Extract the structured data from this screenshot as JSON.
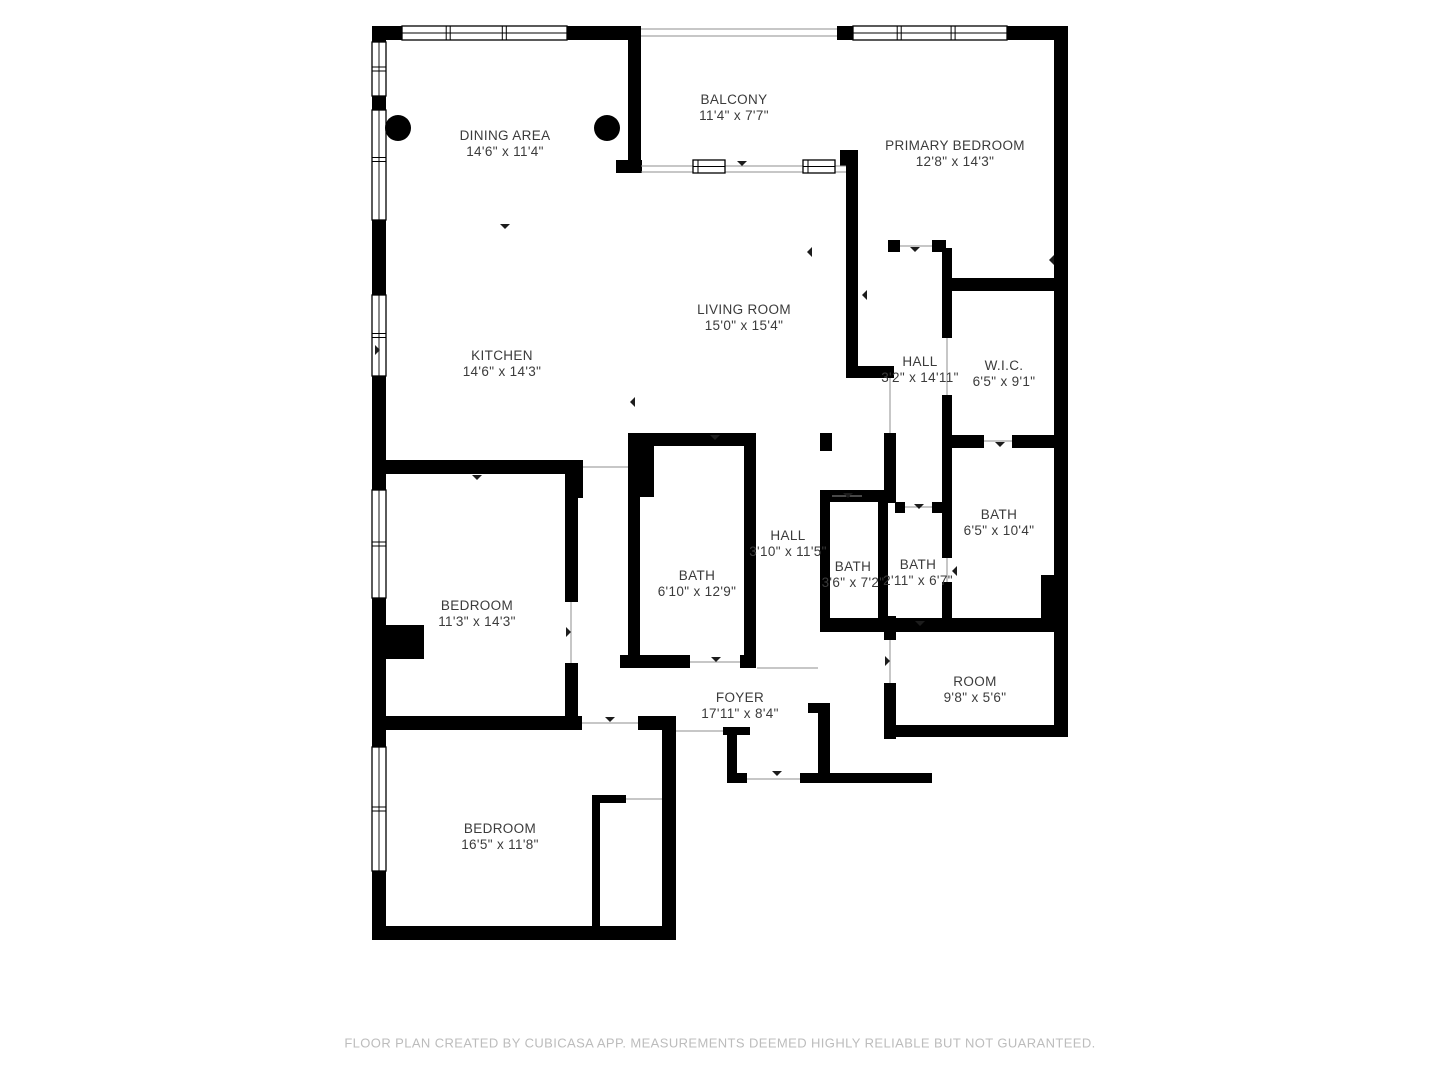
{
  "colors": {
    "wall": "#000000",
    "label": "#3b3b3b",
    "footer": "#bcbcbc",
    "thin_line": "#8f8f8f",
    "background": "#ffffff"
  },
  "rooms": [
    {
      "id": "balcony",
      "name": "BALCONY",
      "dims": "11'4\" x 7'7\"",
      "x": 734,
      "y": 108
    },
    {
      "id": "dining-area",
      "name": "DINING AREA",
      "dims": "14'6\" x 11'4\"",
      "x": 505,
      "y": 144
    },
    {
      "id": "primary-bedroom",
      "name": "PRIMARY BEDROOM",
      "dims": "12'8\" x 14'3\"",
      "x": 955,
      "y": 154
    },
    {
      "id": "living-room",
      "name": "LIVING ROOM",
      "dims": "15'0\" x 15'4\"",
      "x": 744,
      "y": 318
    },
    {
      "id": "kitchen",
      "name": "KITCHEN",
      "dims": "14'6\" x 14'3\"",
      "x": 502,
      "y": 364
    },
    {
      "id": "hall-upper",
      "name": "HALL",
      "dims": "3'2\" x 14'11\"",
      "x": 920,
      "y": 370
    },
    {
      "id": "wic",
      "name": "W.I.C.",
      "dims": "6'5\" x 9'1\"",
      "x": 1004,
      "y": 374
    },
    {
      "id": "bath-ensuite",
      "name": "BATH",
      "dims": "6'5\" x 10'4\"",
      "x": 999,
      "y": 523
    },
    {
      "id": "hall-lower",
      "name": "HALL",
      "dims": "3'10\" x 11'5\"",
      "x": 788,
      "y": 544
    },
    {
      "id": "bath-main",
      "name": "BATH",
      "dims": "6'10\" x 12'9\"",
      "x": 697,
      "y": 584
    },
    {
      "id": "bath-a",
      "name": "BATH",
      "dims": "3'6\" x 7'2\"",
      "x": 853,
      "y": 575
    },
    {
      "id": "bath-b",
      "name": "BATH",
      "dims": "2'11\" x 6'7\"",
      "x": 918,
      "y": 573
    },
    {
      "id": "bedroom-1",
      "name": "BEDROOM",
      "dims": "11'3\" x 14'3\"",
      "x": 477,
      "y": 614
    },
    {
      "id": "room",
      "name": "ROOM",
      "dims": "9'8\" x 5'6\"",
      "x": 975,
      "y": 690
    },
    {
      "id": "foyer",
      "name": "FOYER",
      "dims": "17'11\" x 8'4\"",
      "x": 740,
      "y": 706
    },
    {
      "id": "bedroom-2",
      "name": "BEDROOM",
      "dims": "16'5\" x 11'8\"",
      "x": 500,
      "y": 837
    }
  ],
  "plan": {
    "walls": [
      [
        372,
        26,
        32,
        14
      ],
      [
        567,
        26,
        70,
        14
      ],
      [
        837,
        26,
        16,
        14
      ],
      [
        1007,
        26,
        61,
        14
      ],
      [
        372,
        26,
        14,
        16
      ],
      [
        372,
        96,
        14,
        14
      ],
      [
        372,
        220,
        14,
        75
      ],
      [
        372,
        376,
        14,
        116
      ],
      [
        372,
        598,
        14,
        60
      ],
      [
        372,
        655,
        14,
        75
      ],
      [
        372,
        625,
        52,
        34
      ],
      [
        372,
        727,
        14,
        20
      ],
      [
        372,
        871,
        14,
        69
      ],
      [
        372,
        926,
        304,
        14
      ],
      [
        662,
        727,
        14,
        213
      ],
      [
        1054,
        26,
        14,
        711
      ],
      [
        628,
        26,
        13,
        146
      ],
      [
        616,
        160,
        26,
        13
      ],
      [
        840,
        150,
        18,
        16
      ],
      [
        846,
        166,
        12,
        204
      ],
      [
        846,
        366,
        48,
        12
      ],
      [
        888,
        240,
        12,
        12
      ],
      [
        932,
        240,
        14,
        12
      ],
      [
        942,
        248,
        10,
        90
      ],
      [
        942,
        395,
        10,
        53
      ],
      [
        944,
        278,
        124,
        13
      ],
      [
        942,
        435,
        42,
        13
      ],
      [
        1012,
        435,
        56,
        13
      ],
      [
        942,
        448,
        10,
        110
      ],
      [
        942,
        582,
        10,
        50
      ],
      [
        820,
        618,
        238,
        14
      ],
      [
        1041,
        575,
        17,
        48
      ],
      [
        820,
        433,
        12,
        18
      ],
      [
        884,
        433,
        12,
        70
      ],
      [
        820,
        490,
        76,
        12
      ],
      [
        820,
        500,
        10,
        120
      ],
      [
        878,
        502,
        10,
        118
      ],
      [
        895,
        502,
        10,
        11
      ],
      [
        932,
        502,
        18,
        11
      ],
      [
        652,
        433,
        103,
        13
      ],
      [
        628,
        433,
        26,
        64
      ],
      [
        628,
        495,
        12,
        165
      ],
      [
        744,
        433,
        12,
        235
      ],
      [
        620,
        655,
        70,
        13
      ],
      [
        740,
        655,
        16,
        13
      ],
      [
        378,
        460,
        196,
        14
      ],
      [
        565,
        460,
        16,
        14
      ],
      [
        573,
        460,
        10,
        38
      ],
      [
        565,
        474,
        13,
        128
      ],
      [
        565,
        663,
        13,
        60
      ],
      [
        372,
        716,
        210,
        14
      ],
      [
        638,
        716,
        38,
        14
      ],
      [
        723,
        727,
        27,
        8
      ],
      [
        727,
        735,
        10,
        38
      ],
      [
        727,
        773,
        20,
        10
      ],
      [
        800,
        773,
        132,
        10
      ],
      [
        818,
        705,
        12,
        68
      ],
      [
        808,
        703,
        22,
        10
      ],
      [
        884,
        616,
        12,
        24
      ],
      [
        884,
        683,
        12,
        56
      ],
      [
        884,
        725,
        184,
        12
      ],
      [
        592,
        795,
        8,
        135
      ],
      [
        592,
        795,
        34,
        8
      ]
    ],
    "windows": [
      {
        "x": 402,
        "y": 26,
        "w": 165,
        "h": 14,
        "o": "h",
        "m": [
          0.28,
          0.62
        ]
      },
      {
        "x": 853,
        "y": 26,
        "w": 154,
        "h": 14,
        "o": "h",
        "m": [
          0.3,
          0.65
        ]
      },
      {
        "x": 372,
        "y": 42,
        "w": 14,
        "h": 54,
        "o": "v",
        "m": [
          0.5
        ]
      },
      {
        "x": 372,
        "y": 110,
        "w": 14,
        "h": 110,
        "o": "v",
        "m": [
          0.45
        ]
      },
      {
        "x": 372,
        "y": 295,
        "w": 14,
        "h": 81,
        "o": "v",
        "m": [
          0.5
        ]
      },
      {
        "x": 372,
        "y": 490,
        "w": 14,
        "h": 108,
        "o": "v",
        "m": [
          0.5
        ]
      },
      {
        "x": 372,
        "y": 747,
        "w": 14,
        "h": 124,
        "o": "v",
        "m": [
          0.5
        ]
      }
    ],
    "thin_lines": [
      [
        641,
        29,
        837,
        29
      ],
      [
        641,
        36,
        837,
        36
      ],
      [
        641,
        166,
        846,
        166
      ],
      [
        641,
        172,
        846,
        172
      ],
      [
        890,
        378,
        890,
        433
      ],
      [
        583,
        467,
        628,
        467
      ],
      [
        571,
        602,
        571,
        663
      ],
      [
        582,
        723,
        638,
        723
      ],
      [
        676,
        731,
        723,
        731
      ],
      [
        747,
        779,
        800,
        779
      ],
      [
        690,
        662,
        740,
        662
      ],
      [
        832,
        496,
        862,
        496
      ],
      [
        905,
        507,
        932,
        507
      ],
      [
        900,
        246,
        932,
        246
      ],
      [
        947,
        338,
        947,
        395
      ],
      [
        947,
        558,
        947,
        582
      ],
      [
        984,
        441,
        1012,
        441
      ],
      [
        890,
        640,
        890,
        683
      ],
      [
        757,
        668,
        818,
        668
      ],
      [
        626,
        799,
        662,
        799
      ]
    ],
    "columns": [
      {
        "x": 398,
        "y": 128,
        "r": 13
      },
      {
        "x": 607,
        "y": 128,
        "r": 13
      }
    ],
    "sliding_doors": [
      {
        "x": 693,
        "y": 160,
        "w": 32,
        "h": 13
      },
      {
        "x": 803,
        "y": 160,
        "w": 32,
        "h": 13
      }
    ],
    "ticks": [
      {
        "x": 505,
        "y": 229,
        "d": "down"
      },
      {
        "x": 630,
        "y": 402,
        "d": "left"
      },
      {
        "x": 742,
        "y": 166,
        "d": "down"
      },
      {
        "x": 807,
        "y": 252,
        "d": "left"
      },
      {
        "x": 862,
        "y": 295,
        "d": "left"
      },
      {
        "x": 915,
        "y": 252,
        "d": "down"
      },
      {
        "x": 1000,
        "y": 447,
        "d": "down"
      },
      {
        "x": 952,
        "y": 571,
        "d": "left"
      },
      {
        "x": 848,
        "y": 498,
        "d": "down"
      },
      {
        "x": 919,
        "y": 509,
        "d": "down"
      },
      {
        "x": 571,
        "y": 632,
        "d": "right"
      },
      {
        "x": 610,
        "y": 722,
        "d": "down"
      },
      {
        "x": 777,
        "y": 776,
        "d": "down"
      },
      {
        "x": 890,
        "y": 661,
        "d": "right"
      },
      {
        "x": 716,
        "y": 662,
        "d": "down"
      },
      {
        "x": 477,
        "y": 480,
        "d": "down"
      },
      {
        "x": 1049,
        "y": 260,
        "d": "left"
      },
      {
        "x": 380,
        "y": 350,
        "d": "right"
      },
      {
        "x": 920,
        "y": 626,
        "d": "down"
      },
      {
        "x": 715,
        "y": 440,
        "d": "down"
      }
    ],
    "canvas": {
      "width": 1440,
      "height": 1080
    }
  },
  "footer": {
    "text": "FLOOR PLAN CREATED BY CUBICASA APP. MEASUREMENTS DEEMED HIGHLY RELIABLE BUT NOT GUARANTEED."
  }
}
